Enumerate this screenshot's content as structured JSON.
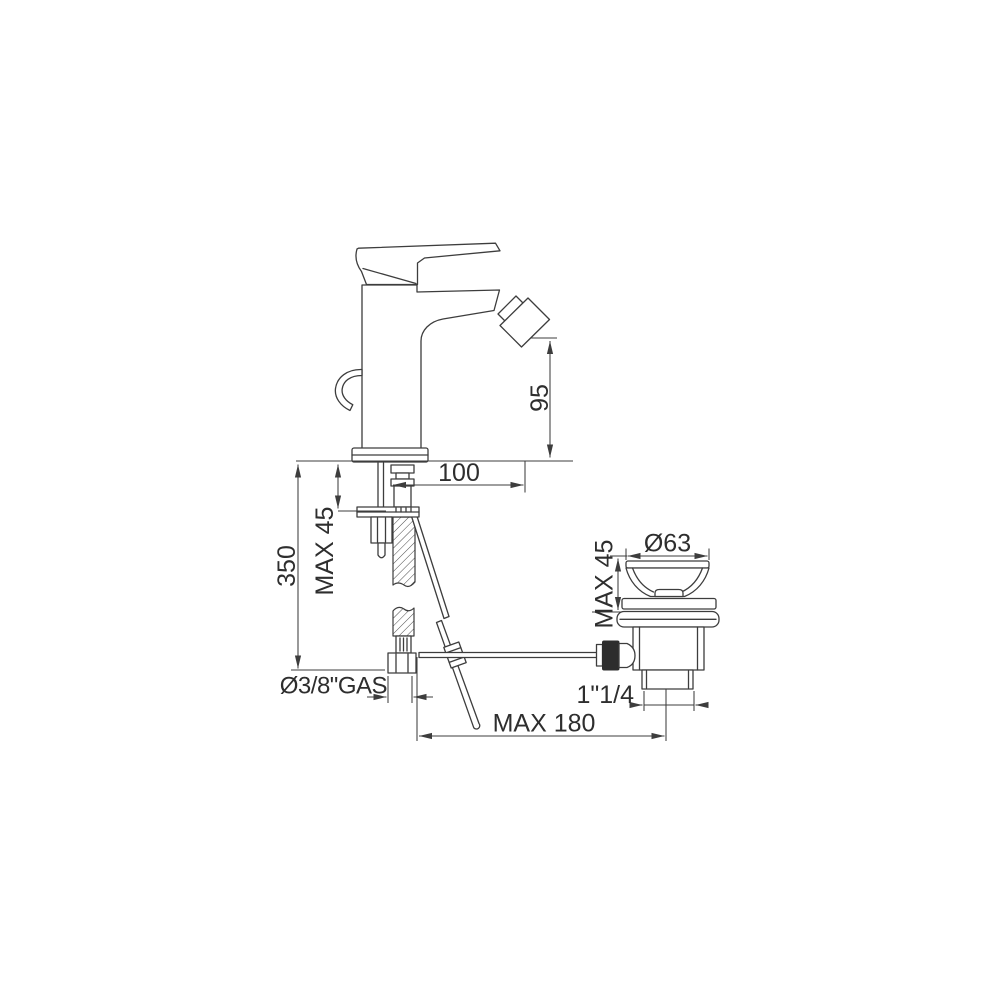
{
  "drawing": {
    "background_color": "#ffffff",
    "line_color": "#3d3d3d",
    "text_color": "#2e2e2e",
    "dark_fill": "#2d2d2d",
    "dimension_labels": {
      "spout_height": "95",
      "spout_projection": "100",
      "mixer_max_deck_thickness": "MAX 45",
      "supply_hose_length": "350",
      "supply_thread": "Ø3/8\"GAS",
      "popup_rod_max_reach": "MAX 180",
      "waste_thread": "1\"1/4",
      "waste_cap_diameter": "Ø63",
      "waste_max_deck_thickness": "MAX 45"
    }
  }
}
